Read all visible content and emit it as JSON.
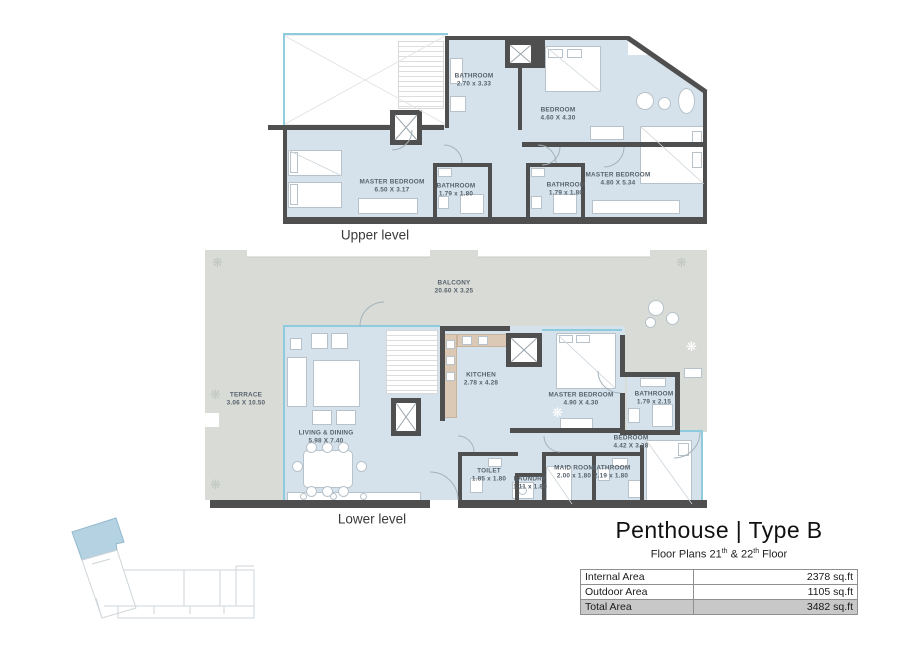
{
  "title_block": {
    "title": "Penthouse | Type B",
    "subtitle": {
      "p1": "Floor Plans 21",
      "sup1": "th",
      "p2": " & 22",
      "sup2": "th",
      "p3": " Floor"
    },
    "table": {
      "rows": [
        {
          "label": "Internal Area",
          "value": "2378 sq.ft"
        },
        {
          "label": "Outdoor Area",
          "value": "1105 sq.ft"
        },
        {
          "label": "Total Area",
          "value": "3482 sq.ft"
        }
      ]
    }
  },
  "upper": {
    "label": "Upper level",
    "rooms": [
      {
        "name": "BATHROOM",
        "dims": "2.70 x 3.33"
      },
      {
        "name": "BEDROOM",
        "dims": "4.60 X 4.30"
      },
      {
        "name": "MASTER BEDROOM",
        "dims": "6.50 X 3.17"
      },
      {
        "name": "BATHROOM",
        "dims": "1.79 x 1.80"
      },
      {
        "name": "BATHROOM",
        "dims": "1.79 x 1.80"
      },
      {
        "name": "MASTER BEDROOM",
        "dims": "4.80 X 5.34"
      }
    ]
  },
  "lower": {
    "label": "Lower level",
    "rooms": [
      {
        "name": "BALCONY",
        "dims": "20.60 X 3.25"
      },
      {
        "name": "TERRACE",
        "dims": "3.06 X 10.50"
      },
      {
        "name": "KITCHEN",
        "dims": "2.78 x 4.28"
      },
      {
        "name": "MASTER BEDROOM",
        "dims": "4.90 X 4.30"
      },
      {
        "name": "BATHROOM",
        "dims": "1.79 x 2.15"
      },
      {
        "name": "LIVING & DINING",
        "dims": "5.98 X 7.40"
      },
      {
        "name": "BEDROOM",
        "dims": "4.42 X 3.28"
      },
      {
        "name": "TOILET",
        "dims": "1.85 x 1.80"
      },
      {
        "name": "LAUNDRY",
        "dims": "1.11 x 1.80"
      },
      {
        "name": "MAID ROOM",
        "dims": "2.00 x 1.80"
      },
      {
        "name": "BATHROOM",
        "dims": "2.19 x 1.80"
      }
    ]
  },
  "icons": {
    "plant": "❋"
  },
  "colors": {
    "wall": "#4f4f4f",
    "room_fill": "#d6e2eb",
    "terrace_fill": "#d9dbd7",
    "window_line": "#8ecbdd",
    "site_highlight": "#b5d2e3",
    "total_row_bg": "#c8c8c8"
  }
}
